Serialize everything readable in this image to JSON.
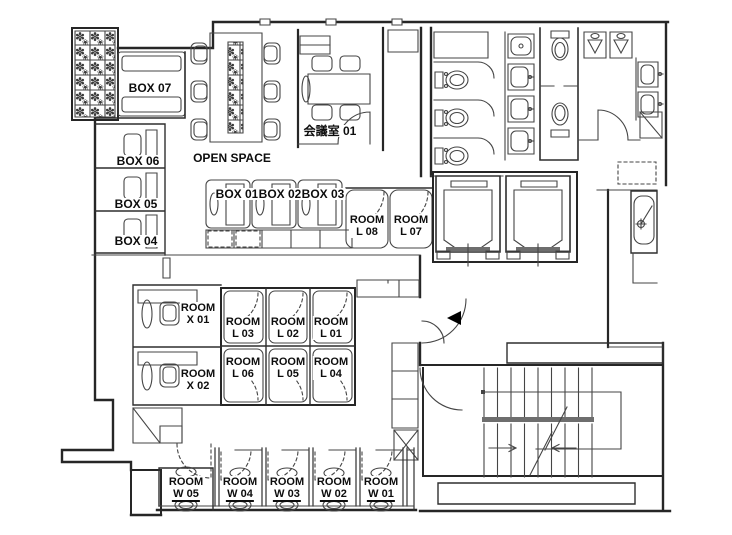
{
  "plan": {
    "title": "office-floor-plan",
    "open_space": {
      "label": "OPEN SPACE"
    },
    "meeting_room": {
      "label": "会議室 01"
    },
    "box_rooms": [
      {
        "label": "BOX 07"
      },
      {
        "label": "BOX 06"
      },
      {
        "label": "BOX 05"
      },
      {
        "label": "BOX 04"
      },
      {
        "label": "BOX 01"
      },
      {
        "label": "BOX 02"
      },
      {
        "label": "BOX 03"
      }
    ],
    "l_rooms": [
      {
        "prefix": "ROOM",
        "number": "L 08"
      },
      {
        "prefix": "ROOM",
        "number": "L 07"
      },
      {
        "prefix": "ROOM",
        "number": "L 03"
      },
      {
        "prefix": "ROOM",
        "number": "L 02"
      },
      {
        "prefix": "ROOM",
        "number": "L 01"
      },
      {
        "prefix": "ROOM",
        "number": "L 06"
      },
      {
        "prefix": "ROOM",
        "number": "L 05"
      },
      {
        "prefix": "ROOM",
        "number": "L 04"
      }
    ],
    "x_rooms": [
      {
        "prefix": "ROOM",
        "number": "X 01"
      },
      {
        "prefix": "ROOM",
        "number": "X 02"
      }
    ],
    "w_rooms": [
      {
        "prefix": "ROOM",
        "number": "W 05"
      },
      {
        "prefix": "ROOM",
        "number": "W 04"
      },
      {
        "prefix": "ROOM",
        "number": "W 03"
      },
      {
        "prefix": "ROOM",
        "number": "W 02"
      },
      {
        "prefix": "ROOM",
        "number": "W 01"
      }
    ],
    "colors": {
      "wall": "#2a2a2a",
      "line": "#454545",
      "dark_fill": "#6e6e6e",
      "text": "#0d0d0d",
      "background": "#ffffff"
    }
  }
}
